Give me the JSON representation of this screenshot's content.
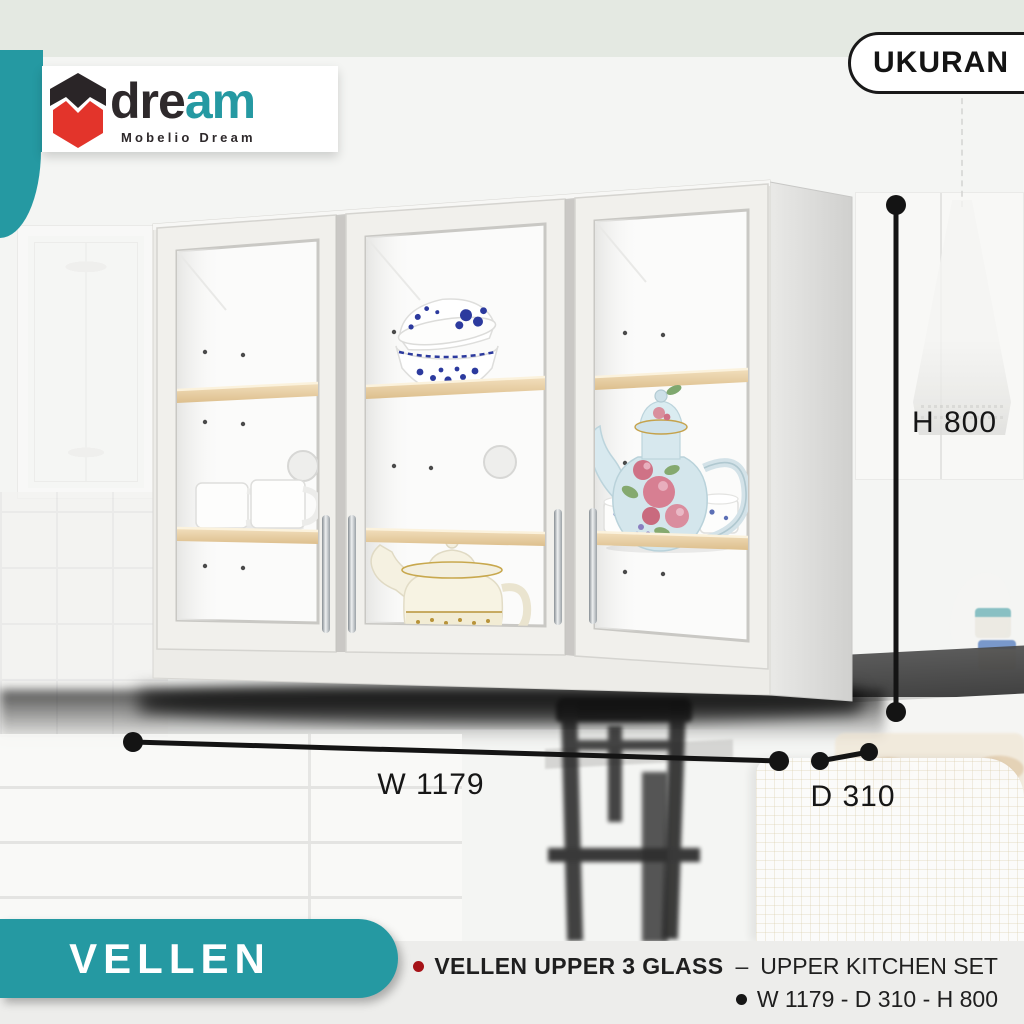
{
  "brand": {
    "wordmark_part1": "dre",
    "wordmark_part2": "am",
    "tagline": "Mobelio Dream"
  },
  "badge": {
    "label": "UKURAN"
  },
  "dimensions": {
    "height_label": "H 800",
    "width_label": "W 1179",
    "depth_label": "D 310"
  },
  "banner": {
    "series_name": "VELLEN"
  },
  "product": {
    "name": "VELLEN UPPER 3 GLASS",
    "divider": "–",
    "category": "UPPER KITCHEN SET",
    "size_summary": "W 1179 - D 310 - H 800"
  },
  "colors": {
    "teal": "#2599A2",
    "logo_red": "#E3342B",
    "logo_black": "#2E292B",
    "dimension_line": "#141414",
    "bullet_red": "#A61318",
    "bullet_black": "#161616",
    "footer_background": "#EDEDEB",
    "shelf_wood": "#E7CE9F",
    "badge_border": "#191919",
    "top_band_green": "#E4E9E2"
  }
}
